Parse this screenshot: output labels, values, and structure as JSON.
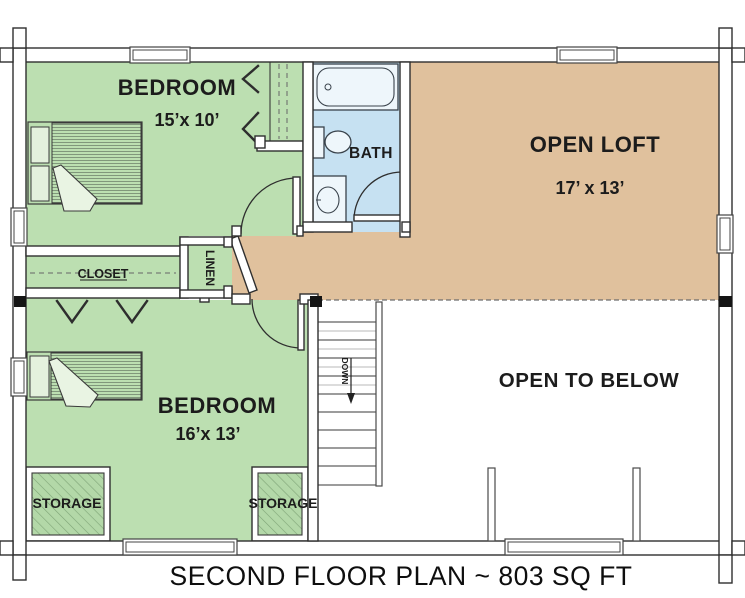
{
  "title": "SECOND FLOOR PLAN ~ 803 SQ FT",
  "colors": {
    "bedroom_green": "#bcdfb1",
    "storage_green": "#b3d8a8",
    "bath_blue": "#c6e1f2",
    "loft_tan": "#e0c19d",
    "wall_outline": "#2f2f2f",
    "label_text": "#1c1c1c",
    "background": "#ffffff"
  },
  "rooms": {
    "bedroom_top": {
      "label": "BEDROOM",
      "dimensions": "15’x 10’"
    },
    "bedroom_bottom": {
      "label": "BEDROOM",
      "dimensions": "16’x 13’"
    },
    "bath": {
      "label": "BATH"
    },
    "open_loft": {
      "label": "OPEN LOFT",
      "dimensions": "17’ x 13’"
    },
    "open_to_below": {
      "label": "OPEN TO BELOW"
    },
    "closet": {
      "label": "CLOSET"
    },
    "linen": {
      "label": "LINEN"
    },
    "storage_left": {
      "label": "STORAGE"
    },
    "storage_right": {
      "label": "STORAGE"
    },
    "stairs": {
      "label": "DOWN"
    }
  }
}
